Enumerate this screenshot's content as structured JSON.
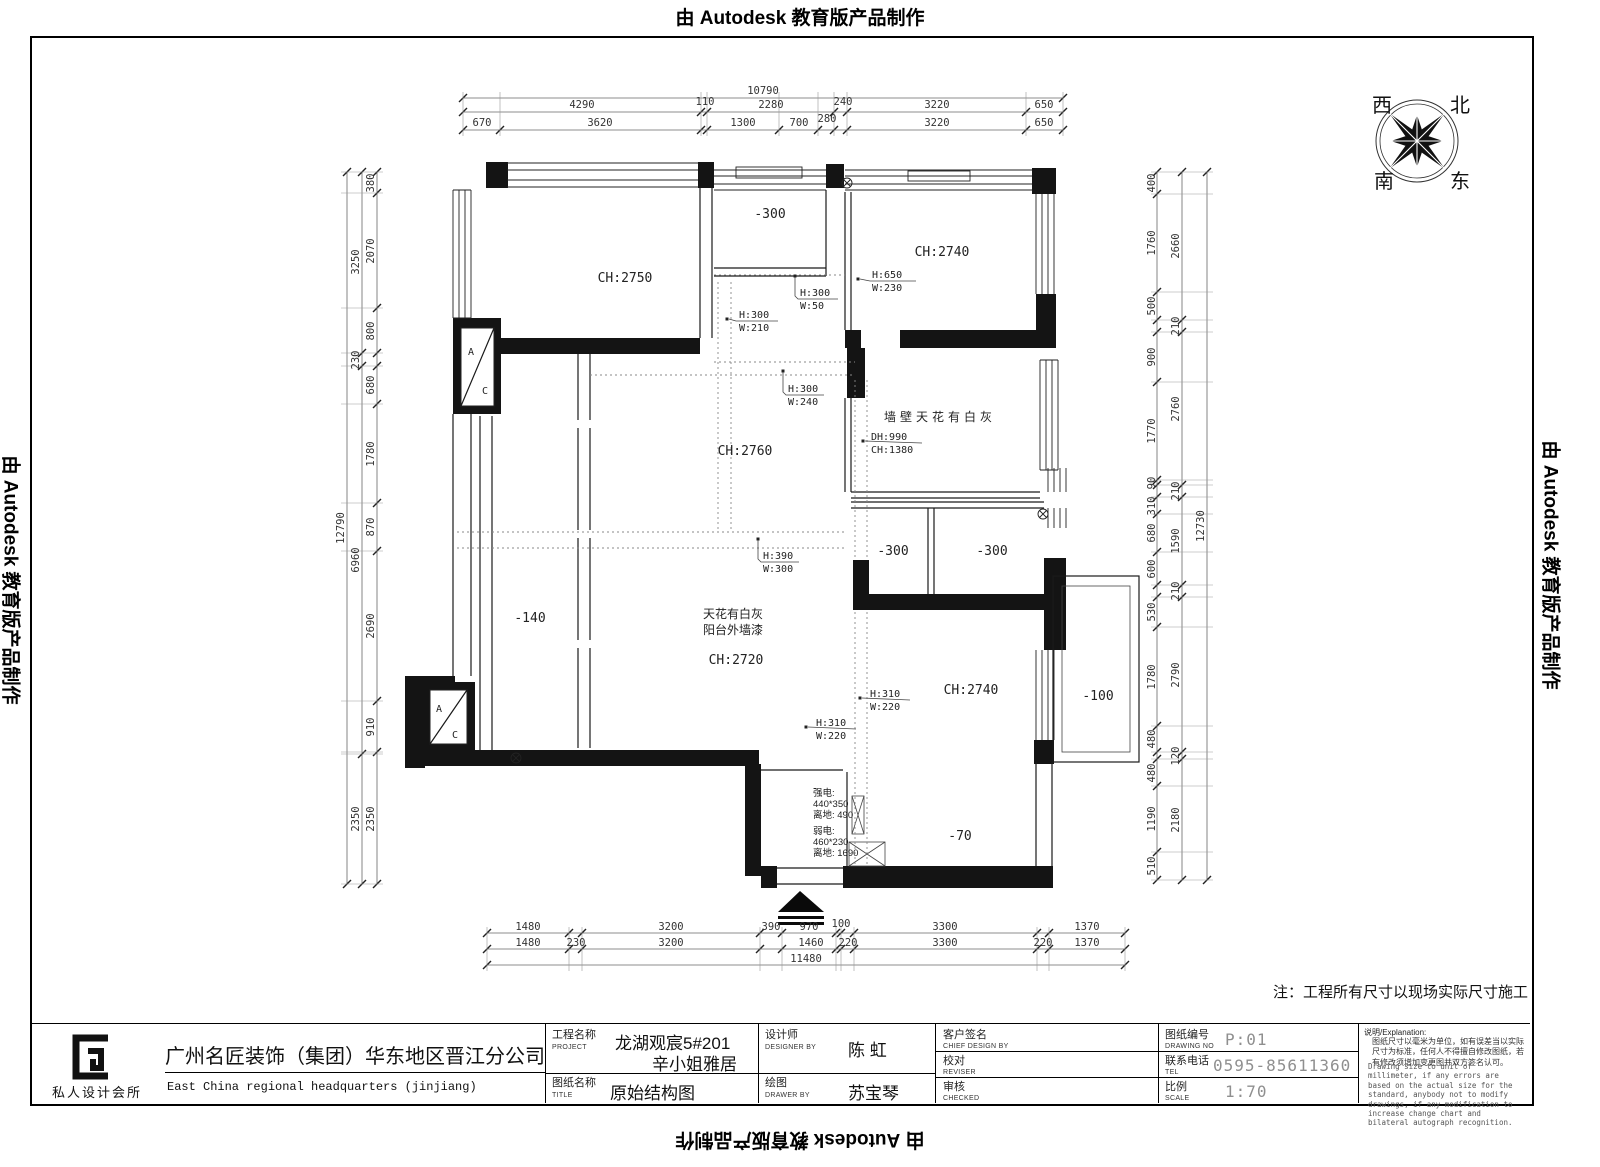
{
  "stamp": "由 Autodesk 教育版产品制作",
  "note": "注：工程所有尺寸以现场实际尺寸施工",
  "compass": {
    "west": "西",
    "north": "北",
    "south": "南",
    "east": "东"
  },
  "dims": {
    "top": {
      "overall": "10790",
      "row2": [
        "4290",
        "110",
        "2280",
        "240",
        "3220",
        "650"
      ],
      "row3": [
        "670",
        "3620",
        "1300",
        "700",
        "280",
        "3220",
        "650"
      ]
    },
    "bottom": {
      "row1": [
        "1480",
        "3200",
        "390",
        "970",
        "100",
        "3300",
        "1370"
      ],
      "row2": [
        "1480",
        "230",
        "3200",
        "1460",
        "220",
        "3300",
        "220",
        "1370"
      ],
      "overall": "11480"
    },
    "left": {
      "overall": "12790",
      "mid": [
        "3250",
        "230",
        "6960",
        "2350"
      ],
      "inner": [
        "380",
        "2070",
        "800",
        "680",
        "1780",
        "870",
        "2690",
        "910",
        "2350"
      ]
    },
    "right": {
      "overall": "12730",
      "mid": [
        "2660",
        "210",
        "2760",
        "210",
        "1590",
        "210",
        "2790",
        "120",
        "2180"
      ],
      "inner": [
        "400",
        "1760",
        "500",
        "900",
        "1770",
        "90",
        "310",
        "680",
        "600",
        "530",
        "1780",
        "480",
        "480",
        "1190",
        "510"
      ]
    }
  },
  "rooms": {
    "tl_ch": "CH:2750",
    "balcony_top": "-300",
    "tr_ch": "CH:2740",
    "wall_room": "墙壁天花有白灰",
    "center_ch": "CH:2760",
    "small_a": "-300",
    "small_b": "-300",
    "left_room": "-140",
    "living_l1": "天花有白灰",
    "living_l2": "阳台外墙漆",
    "living_ch": "CH:2720",
    "br_ch": "CH:2740",
    "bay": "-100",
    "bottom_room": "-70",
    "ac_a": "A",
    "ac_c": "C"
  },
  "annos": {
    "a1": {
      "l1": "H:300",
      "l2": "W:210"
    },
    "a2": {
      "l1": "H:300",
      "l2": "W:50"
    },
    "a3": {
      "l1": "H:650",
      "l2": "W:230"
    },
    "a4": {
      "l1": "H:300",
      "l2": "W:240"
    },
    "a5": {
      "l1": "DH:990",
      "l2": "CH:1380"
    },
    "a6": {
      "l1": "H:390",
      "l2": "W:300"
    },
    "a7": {
      "l1": "H:310",
      "l2": "W:220"
    },
    "a8": {
      "l1": "H:310",
      "l2": "W:220"
    },
    "power": {
      "l1": "强电:",
      "l2": "440*350",
      "l3": "离地: 490"
    },
    "weak": {
      "l1": "弱电:",
      "l2": "460*230",
      "l3": "离地: 1690"
    }
  },
  "titleblock": {
    "logo_caption": "私人设计会所",
    "company_cn": "广州名匠装饰（集团）华东地区晋江分公司",
    "company_en": "East China regional headquarters (jinjiang)",
    "project_label": "工程名称",
    "project_label_en": "PROJECT",
    "project_value1": "龙湖观宸5#201",
    "project_value2": "辛小姐雅居",
    "designer_label": "设计师",
    "designer_label_en": "DESIGNER BY",
    "designer_value": "陈 虹",
    "drawing_label": "图纸名称",
    "drawing_label_en": "TITLE",
    "drawing_value": "原始结构图",
    "drawer_label": "绘图",
    "drawer_label_en": "DRAWER BY",
    "drawer_value": "苏宝琴",
    "client_label": "客户签名",
    "client_label_en": "CHIEF DESIGN BY",
    "reviser_label": "校对",
    "reviser_label_en": "REVISER",
    "checker_label": "审核",
    "checker_label_en": "CHECKED",
    "no_label": "图纸编号",
    "no_label_en": "DRAWING NO",
    "no_value": "P:01",
    "tel_label": "联系电话",
    "tel_label_en": "TEL",
    "tel_value": "0595-85611360",
    "scale_label": "比例",
    "scale_label_en": "SCALE",
    "scale_value": "1:70",
    "remark_title": "说明/Explanation:",
    "remark_cn": "图纸尺寸以毫米为单位，如有误差当以实际尺寸为标准，任何人不得擅自修改图纸，若有修改须增加变更图并双方签名认可。",
    "remark_en": "Drawing size to unit of millimeter, if any errors are based on the actual size for the standard, anybody not to modify drawings, if any modification to increase change chart and bilateral autograph recognition."
  }
}
